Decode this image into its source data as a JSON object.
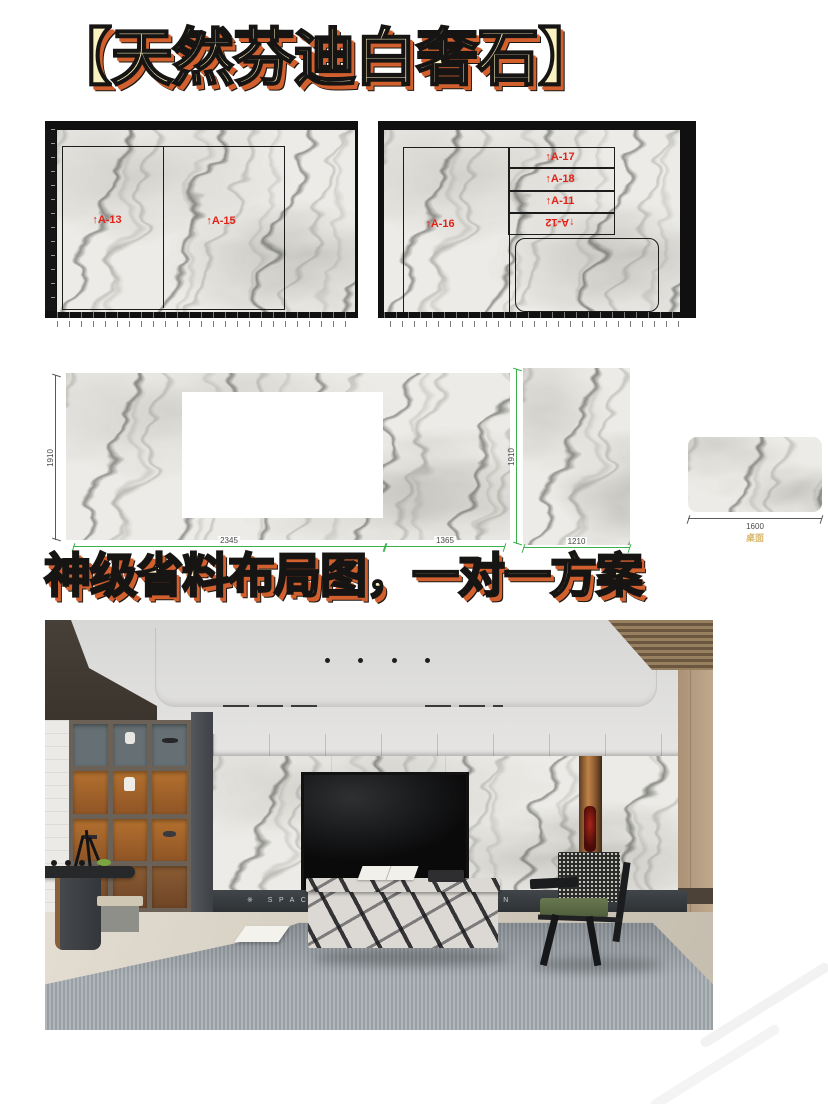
{
  "title": "【天然芬迪白奢石】",
  "subtitle": "神级省料布局图，一对一方案",
  "boards": {
    "left": {
      "labels": [
        "↑A-13",
        "↑A-15"
      ]
    },
    "right": {
      "main_label": "↑A-16",
      "strip_labels": [
        "↑A-17",
        "↑A-18",
        "↑A-11",
        "↑A-12"
      ]
    }
  },
  "dims": {
    "wall_height": "1910",
    "panel_height": "1910",
    "widths": [
      "2345",
      "1365",
      "1210"
    ],
    "tabletop_width": "1600",
    "tabletop_caption": "桌面"
  },
  "photo": {
    "plinth_text": "※  SPACE AESTHETICS DESIGN"
  },
  "colors": {
    "headline_fill": "#fbf2c2",
    "headline_extrude": "#d2602e",
    "label_red": "#e2231a",
    "dim_green": "#3bb24a",
    "caption_tan": "#d8b86e"
  }
}
